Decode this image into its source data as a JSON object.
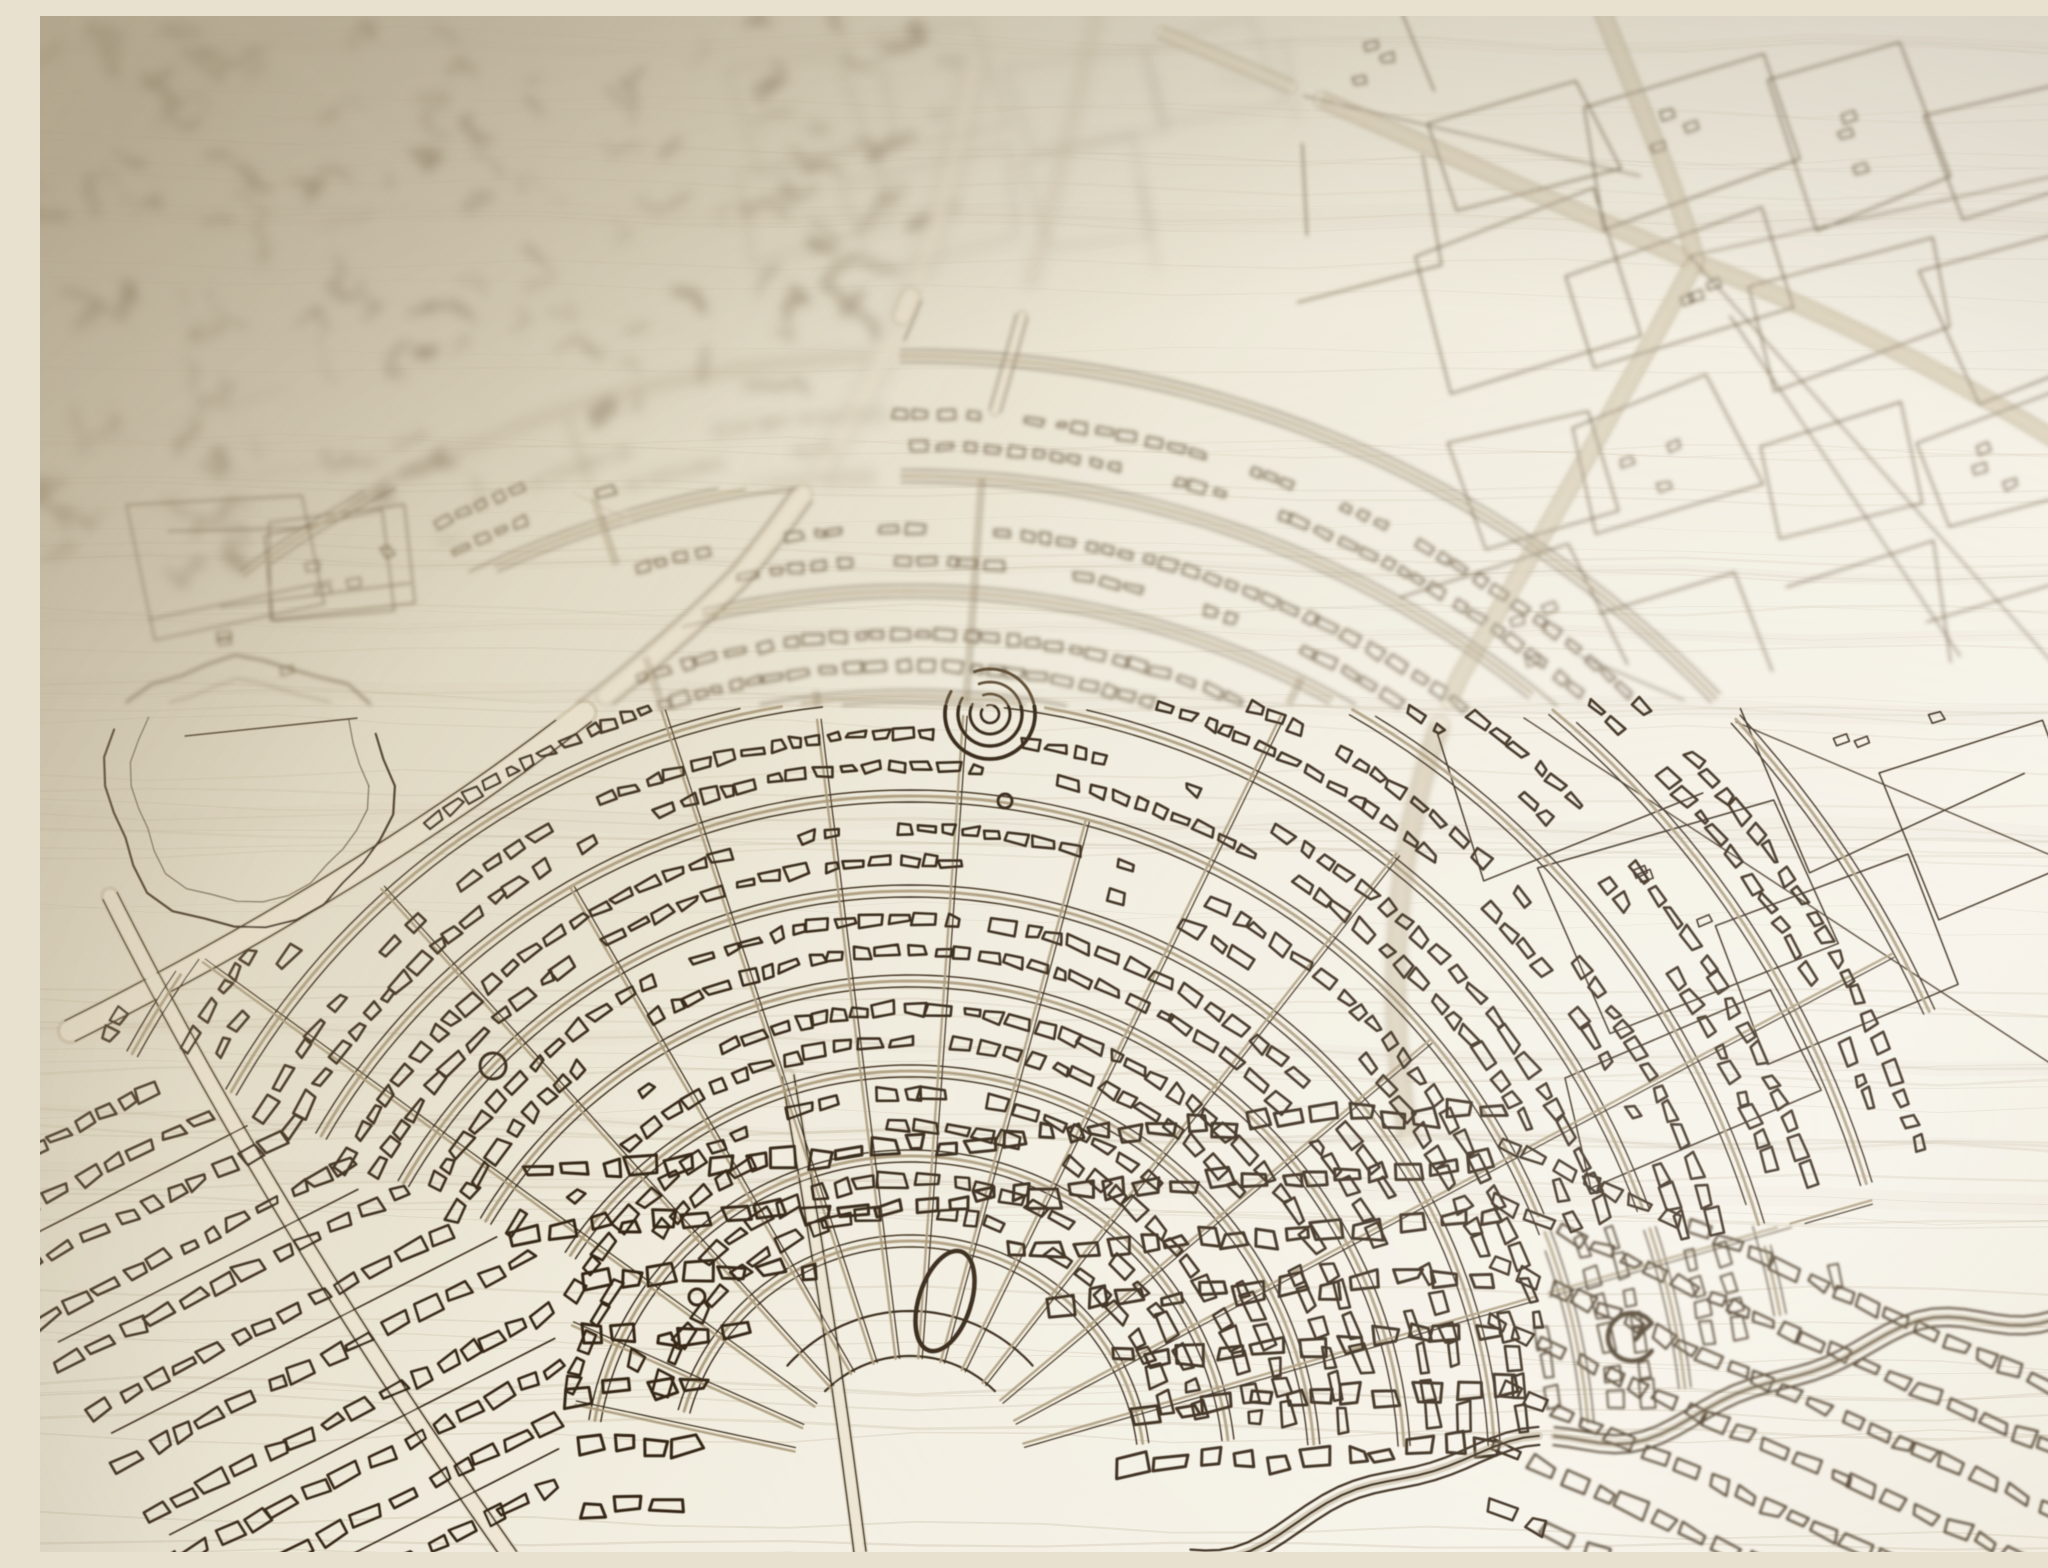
{
  "scene": {
    "subject": "Close-up photograph of a city street map laser-burned into pale plywood: dark brown engraved streets and building footprints, a crescent of concentric ring boulevards with radial avenues, a bullseye plaza, a highway interchange in the upper right, a lake on the left, dense row housing in the sharp foreground, and strong depth-of-field blur toward the upper left corner",
    "text_content": "none - the engraving contains no readable text",
    "palette": {
      "wood_shadow": "#d6cdb8",
      "wood_mid": "#e9e3d1",
      "wood_light": "#f3efe2",
      "wood_highlight": "#f7f3e9",
      "burn_near": "#362818",
      "burn_soft": "#4a3a27",
      "burn_mid": "#5e4d36",
      "burn_far": "#85765e",
      "road_tan": "#a99878",
      "road_pale": "#efe8d5",
      "road_casing": "#bdaf92",
      "grain": "#b9ac90",
      "corner_haze": "#c8bc9e",
      "vignette": "#5c4e3a"
    },
    "geometry": {
      "ring_center": {
        "x": 870,
        "y": 1460
      },
      "rings": [
        [
          235,
          196,
          352
        ],
        [
          320,
          190,
          354
        ],
        [
          405,
          186,
          356
        ],
        [
          495,
          184,
          357
        ],
        [
          585,
          183,
          357
        ],
        [
          680,
          183,
          356
        ],
        [
          780,
          184,
          354
        ],
        [
          885,
          186,
          350
        ],
        [
          1000,
          190,
          344
        ],
        [
          1120,
          196,
          336
        ]
      ],
      "radial_angles": [
        192,
        204,
        216,
        228,
        240,
        252,
        263,
        274,
        285,
        296,
        308,
        320,
        332,
        344
      ],
      "tree_arcs": [
        [
          540,
          248,
          330
        ],
        [
          1040,
          252,
          318
        ]
      ],
      "plaza_arcs": [
        [
          120,
          225,
          315
        ],
        [
          165,
          222,
          318
        ]
      ],
      "bullseye": {
        "x": 950,
        "y": 698,
        "radii": [
          9,
          20,
          32,
          45
        ]
      },
      "pond": {
        "x": 905,
        "y": 1285,
        "rx": 26,
        "ry": 52,
        "rot": 18
      },
      "spiral_building": {
        "x": 1592,
        "y": 1321,
        "r": 24
      },
      "roundabouts": [
        [
          453,
          1050,
          13
        ],
        [
          657,
          1281,
          8
        ],
        [
          965,
          785,
          7
        ]
      ],
      "interchange": {
        "x": 1650,
        "y": 240
      },
      "lake": {
        "x": 210,
        "y": 770,
        "rx": 150,
        "ry": 140
      },
      "road_a": [
        [
          935,
          40
        ],
        [
          905,
          220
        ],
        [
          850,
          380
        ],
        [
          700,
          560
        ],
        [
          540,
          720
        ],
        [
          300,
          880
        ],
        [
          30,
          1015
        ]
      ],
      "road_c": [
        [
          70,
          880
        ],
        [
          160,
          1060
        ],
        [
          300,
          1300
        ],
        [
          470,
          1540
        ]
      ],
      "road_d": [
        [
          748,
          1060
        ],
        [
          790,
          1300
        ],
        [
          820,
          1536
        ]
      ],
      "canal": {
        "x0": 1150,
        "y0": 1530,
        "x1": 2060,
        "y1": 1275,
        "amp": 15
      },
      "seeds": {
        "grain": 11,
        "far": 23,
        "parcels": 37,
        "blocks": 51,
        "rows": 67
      }
    }
  }
}
